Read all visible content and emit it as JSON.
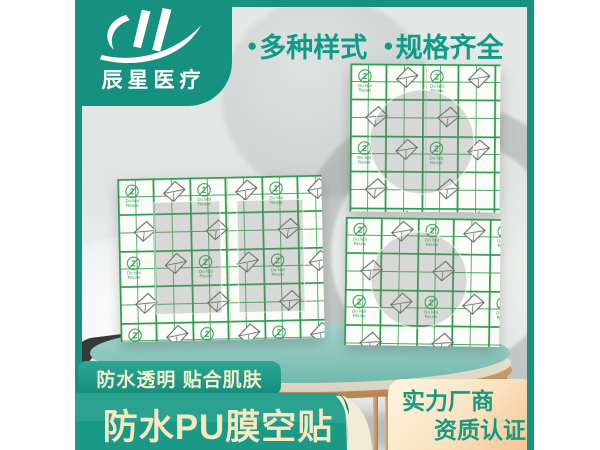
{
  "brand": {
    "logo_text": "辰星医疗"
  },
  "header": {
    "bullets": [
      {
        "marker": "●",
        "label": "多种样式"
      },
      {
        "marker": "●",
        "label": "规格齐全"
      }
    ]
  },
  "sheet_pattern": {
    "reuse_number": "2",
    "do_not_line1": "Do Not",
    "do_not_line2": "Reuse"
  },
  "footer": {
    "feature_badge": "防水透明 贴合肌肤",
    "title_badge": "防水PU膜空贴",
    "cert_box": {
      "line1": "实力厂商",
      "line2": "资质认证"
    }
  },
  "colors": {
    "brand_teal": "#17917f",
    "ribbon_teal_light": "#2aa28e",
    "ribbon_teal_dark": "#0f8878",
    "badge_text_cream": "#f1efcd",
    "title_text_cream": "#f6e8bf",
    "cert_bg_top": "#fdf5e0",
    "cert_bg_bottom": "#f5c594",
    "cert_text_teal": "#17997e",
    "bullet_text_teal": "#0f9b8a",
    "grid_green": "#35a257",
    "table_teal": "#8cc7be",
    "table_gold": "#c79c6c",
    "background_gray": "#e4e7e6"
  }
}
